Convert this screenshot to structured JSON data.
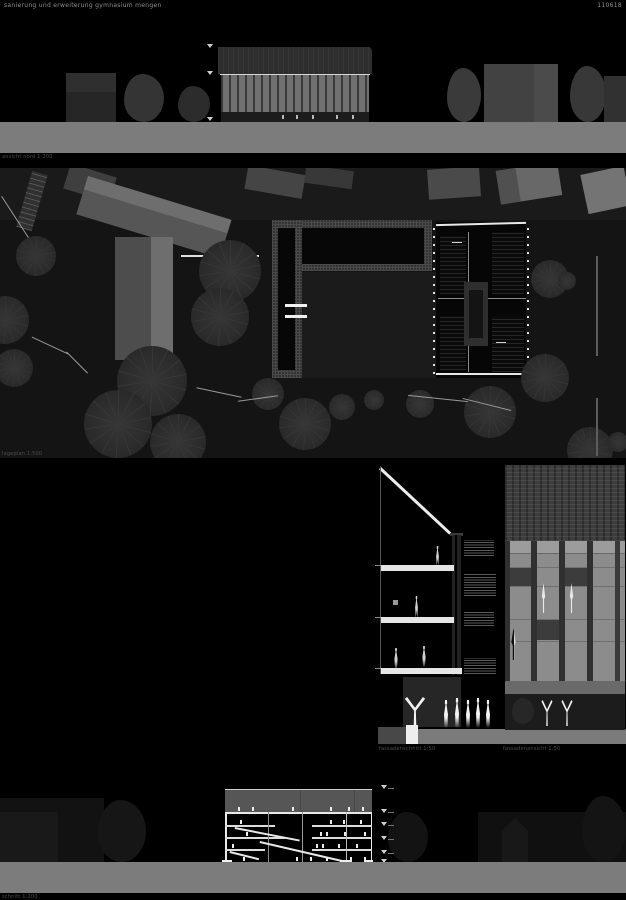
{
  "board": {
    "title": "sanierung und erweiterung gymnasium mengen",
    "code": "110618",
    "background_color": "#000000",
    "ground_color": "#7c7c7c",
    "line_color": "#e8e8e8"
  },
  "drawings": {
    "north_elevation": {
      "label": "ansicht nord 1:200"
    },
    "site_plan": {
      "label": "lageplan 1:500"
    },
    "facade_section": {
      "label": "fassadenschnitt 1:50"
    },
    "facade_detail": {
      "label": "fassadenansicht 1:50"
    },
    "long_section": {
      "label": "schnitt 1:200"
    }
  }
}
